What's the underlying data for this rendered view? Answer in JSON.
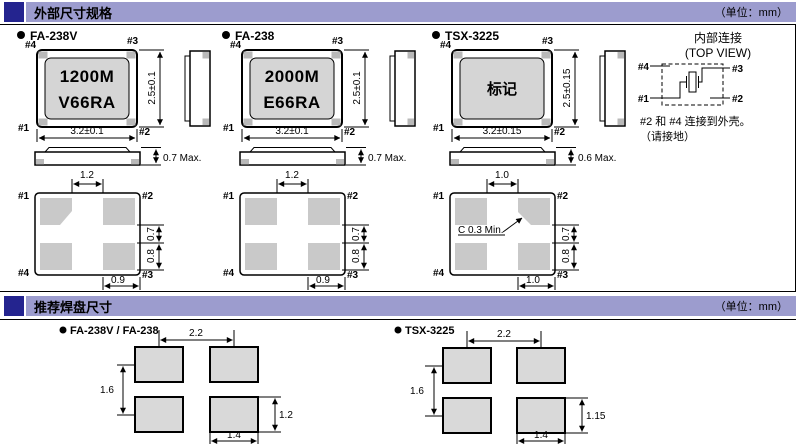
{
  "header": {
    "unit_label": "（单位：mm）",
    "section1_title": "外部尺寸规格",
    "section2_title": "推荐焊盘尺寸"
  },
  "packages": [
    {
      "name": "FA-238V",
      "marking_line1": "1200M",
      "marking_line2": "V66RA",
      "body_width": "3.2±0.1",
      "body_height": "2.5±0.1",
      "max_thickness": "0.7 Max.",
      "pins": {
        "top_left": "#4",
        "top_right": "#3",
        "bottom_left": "#1",
        "bottom_right": "#2"
      },
      "land": {
        "pins": {
          "top_left": "#1",
          "top_right": "#2",
          "bottom_left": "#4",
          "bottom_right": "#3"
        },
        "top_gap": "1.2",
        "right_upper": "0.7",
        "right_lower": "0.8",
        "bottom": "0.9"
      }
    },
    {
      "name": "FA-238",
      "marking_line1": "2000M",
      "marking_line2": "E66RA",
      "body_width": "3.2±0.1",
      "body_height": "2.5±0.1",
      "max_thickness": "0.7 Max.",
      "pins": {
        "top_left": "#4",
        "top_right": "#3",
        "bottom_left": "#1",
        "bottom_right": "#2"
      },
      "land": {
        "pins": {
          "top_left": "#1",
          "top_right": "#2",
          "bottom_left": "#4",
          "bottom_right": "#3"
        },
        "top_gap": "1.2",
        "right_upper": "0.7",
        "right_lower": "0.8",
        "bottom": "0.9"
      }
    },
    {
      "name": "TSX-3225",
      "marking_line1": "标记",
      "body_width": "3.2±0.15",
      "body_height": "2.5±0.15",
      "max_thickness": "0.6 Max.",
      "pins": {
        "top_left": "#4",
        "top_right": "#3",
        "bottom_left": "#1",
        "bottom_right": "#2"
      },
      "land": {
        "pins": {
          "top_left": "#1",
          "top_right": "#2",
          "bottom_left": "#4",
          "bottom_right": "#3"
        },
        "top_gap": "1.0",
        "right_upper": "0.7",
        "right_lower": "0.8",
        "bottom": "1.0",
        "chamfer_note": "C 0.3 Min."
      }
    }
  ],
  "internal_connection": {
    "title": "内部连接",
    "subtitle": "(TOP VIEW)",
    "pins": {
      "top_left": "#4",
      "top_right": "#3",
      "bottom_left": "#1",
      "bottom_right": "#2"
    },
    "note_line1": "#2 和 #4 连接到外壳。",
    "note_line2": "（请接地）"
  },
  "land_patterns": [
    {
      "name": "FA-238V / FA-238",
      "pitch_x": "2.2",
      "pitch_y": "1.6",
      "pad_width": "1.4",
      "pad_height": "1.2"
    },
    {
      "name": "TSX-3225",
      "pitch_x": "2.2",
      "pitch_y": "1.6",
      "pad_width": "1.4",
      "pad_height": "1.15"
    }
  ],
  "colors": {
    "accent_square": "#24248f",
    "accent_bar": "#9c9cce",
    "package_face": "#d5d5d5",
    "pad_fill": "#c9c9c9",
    "pad_fill_light": "#d9d9d9",
    "terminal_fill": "#b9b9b9"
  }
}
